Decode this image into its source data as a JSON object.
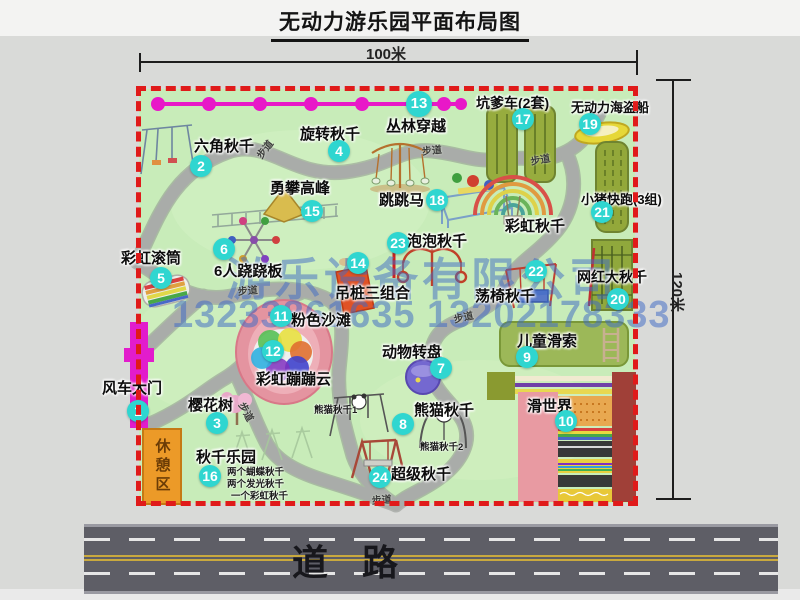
{
  "title": "无动力游乐园平面布局图",
  "dimension_top": "100米",
  "dimension_right": "120米",
  "road_label": "道路",
  "rest_area_label": "休憩区",
  "walkway_label": "步道",
  "watermark": {
    "company": "游乐设备有限公司",
    "phones": "13233861635 13202178333"
  },
  "colors": {
    "park_green": "#c8ecb9",
    "border_red": "#e01a1a",
    "marker_cyan": "#2fd6d0",
    "path_gray": "#a7aaa7",
    "road_gray": "#5e5e66",
    "gate_magenta": "#e21ccc",
    "zipline_magenta": "#e818c8",
    "rest_area_orange": "#ec9a28",
    "watermark_blue": "#4a74c8"
  },
  "map": {
    "attractions": [
      {
        "num": "1",
        "label": "风车大门",
        "lx": 102,
        "ly": 377,
        "nx": 138,
        "ny": 411
      },
      {
        "num": "2",
        "label": "六角秋千",
        "lx": 194,
        "ly": 135,
        "nx": 201,
        "ny": 166
      },
      {
        "num": "3",
        "label": "樱花树",
        "lx": 188,
        "ly": 394,
        "nx": 217,
        "ny": 423
      },
      {
        "num": "4",
        "label": "旋转秋千",
        "lx": 300,
        "ly": 123,
        "nx": 339,
        "ny": 151
      },
      {
        "num": "5",
        "label": "彩虹滚筒",
        "lx": 121,
        "ly": 247,
        "nx": 161,
        "ny": 278
      },
      {
        "num": "6",
        "label": "6人跷跷板",
        "lx": 214,
        "ly": 260,
        "nx": 224,
        "ny": 249
      },
      {
        "num": "7",
        "label": "动物转盘",
        "lx": 382,
        "ly": 341,
        "nx": 441,
        "ny": 368
      },
      {
        "num": "8",
        "label": "熊猫秋千",
        "lx": 414,
        "ly": 399,
        "nx": 403,
        "ny": 424
      },
      {
        "num": "9",
        "label": "儿童滑索",
        "lx": 517,
        "ly": 330,
        "nx": 527,
        "ny": 357
      },
      {
        "num": "10",
        "label": "滑世界",
        "lx": 527,
        "ly": 395,
        "nx": 566,
        "ny": 421
      },
      {
        "num": "11",
        "label": "粉色沙滩",
        "lx": 291,
        "ly": 309,
        "nx": 281,
        "ny": 316
      },
      {
        "num": "12",
        "label": "彩虹蹦蹦云",
        "lx": 256,
        "ly": 368,
        "nx": 273,
        "ny": 351
      },
      {
        "num": "13",
        "label": "丛林穿越",
        "lx": 386,
        "ly": 115,
        "nx": 419,
        "ny": 104
      },
      {
        "num": "14",
        "label": "吊桩三组合",
        "lx": 335,
        "ly": 282,
        "nx": 358,
        "ny": 263
      },
      {
        "num": "15",
        "label": "勇攀高峰",
        "lx": 270,
        "ly": 177,
        "nx": 312,
        "ny": 211
      },
      {
        "num": "16",
        "label": "秋千乐园",
        "lx": 196,
        "ly": 446,
        "nx": 210,
        "ny": 476
      },
      {
        "num": "17",
        "label": "坑爹车(2套)",
        "lx": 476,
        "ly": 93,
        "nx": 523,
        "ny": 119,
        "fs": 14
      },
      {
        "num": "18",
        "label": "跳跳马",
        "lx": 379,
        "ly": 189,
        "nx": 437,
        "ny": 200
      },
      {
        "num": "19",
        "label": "无动力海盗船",
        "lx": 571,
        "ly": 97,
        "nx": 590,
        "ny": 124,
        "fs": 13
      },
      {
        "num": "20",
        "label": "网红大秋千",
        "lx": 577,
        "ly": 267,
        "nx": 618,
        "ny": 299,
        "fs": 14
      },
      {
        "num": "21",
        "label": "小猪快跑(3组)",
        "lx": 581,
        "ly": 189,
        "nx": 602,
        "ny": 212,
        "fs": 13
      },
      {
        "num": "22",
        "label": "荡椅秋千",
        "lx": 475,
        "ly": 285,
        "nx": 536,
        "ny": 271
      },
      {
        "num": "23",
        "label": "泡泡秋千",
        "lx": 407,
        "ly": 230,
        "nx": 398,
        "ny": 243
      },
      {
        "num": "24",
        "label": "超级秋千",
        "lx": 391,
        "ly": 463,
        "nx": 380,
        "ny": 477
      },
      {
        "num": null,
        "label": "彩虹秋千",
        "lx": 505,
        "ly": 215,
        "nx": 0,
        "ny": 0
      }
    ],
    "walkway_labels": [
      {
        "x": 252,
        "y": 152,
        "rot": -52
      },
      {
        "x": 421,
        "y": 143,
        "rot": -6
      },
      {
        "x": 529,
        "y": 153,
        "rot": -10
      },
      {
        "x": 237,
        "y": 283,
        "rot": -5
      },
      {
        "x": 452,
        "y": 311,
        "rot": -12
      },
      {
        "x": 249,
        "y": 399,
        "rot": 62
      },
      {
        "x": 371,
        "y": 492,
        "rot": -4
      }
    ],
    "small_notes": [
      {
        "text": "熊猫秋千1",
        "x": 314,
        "y": 402
      },
      {
        "text": "熊猫秋千2",
        "x": 420,
        "y": 439
      },
      {
        "text": "两个蝴蝶秋千",
        "x": 227,
        "y": 464
      },
      {
        "text": "两个发光秋千",
        "x": 227,
        "y": 476
      },
      {
        "text": "一个彩虹秋千",
        "x": 231,
        "y": 488
      }
    ]
  }
}
